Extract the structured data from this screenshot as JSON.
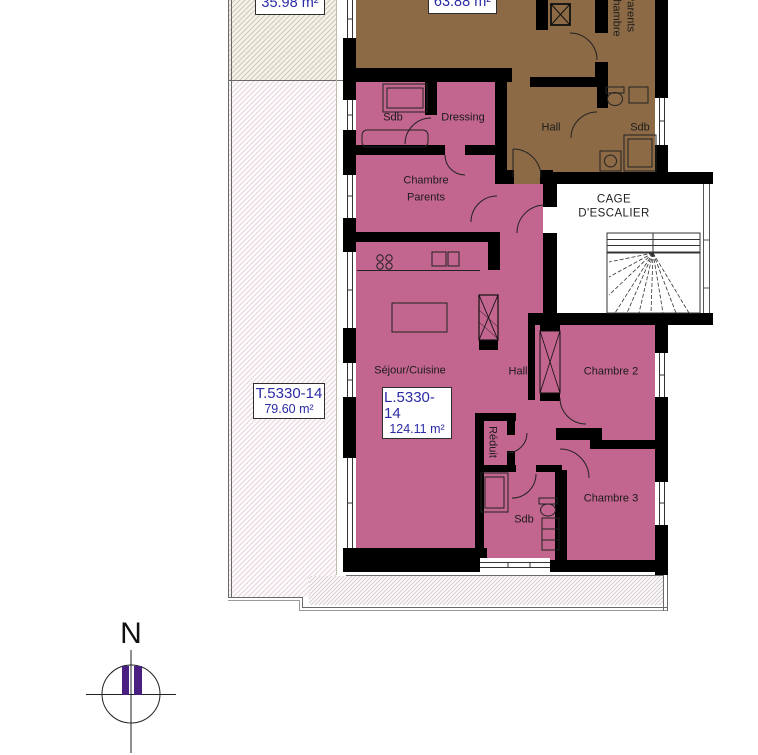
{
  "colors": {
    "apartment_pink": "#c2658f",
    "apartment_brown": "#8c6a46",
    "label_blue": "#2a2aa6",
    "compass_purple": "#4a1f82",
    "wall_black": "#000000"
  },
  "areas": {
    "terrace_upper": "35.98 m²",
    "apartment_brown": "63.88 m²"
  },
  "unit_boxes": {
    "terrace": {
      "id": "T.5330-14",
      "area": "79.60 m²"
    },
    "apartment": {
      "id": "L.5330-14",
      "area": "124.11 m²"
    }
  },
  "rooms_brown": {
    "chambre_parents_line1": "Chambre",
    "chambre_parents_line2": "Parents",
    "hall": "Hall",
    "sdb": "Sdb"
  },
  "rooms_pink": {
    "sdb": "Sdb",
    "dressing": "Dressing",
    "chambre_parents_line1": "Chambre",
    "chambre_parents_line2": "Parents",
    "sejour_cuisine": "Séjour/Cuisine",
    "hall": "Hall",
    "chambre2": "Chambre 2",
    "reduit": "Réduit",
    "sdb2": "Sdb",
    "chambre3": "Chambre 3"
  },
  "stairwell": {
    "line1": "CAGE",
    "line2": "D'ESCALIER"
  },
  "compass": {
    "north": "N"
  }
}
